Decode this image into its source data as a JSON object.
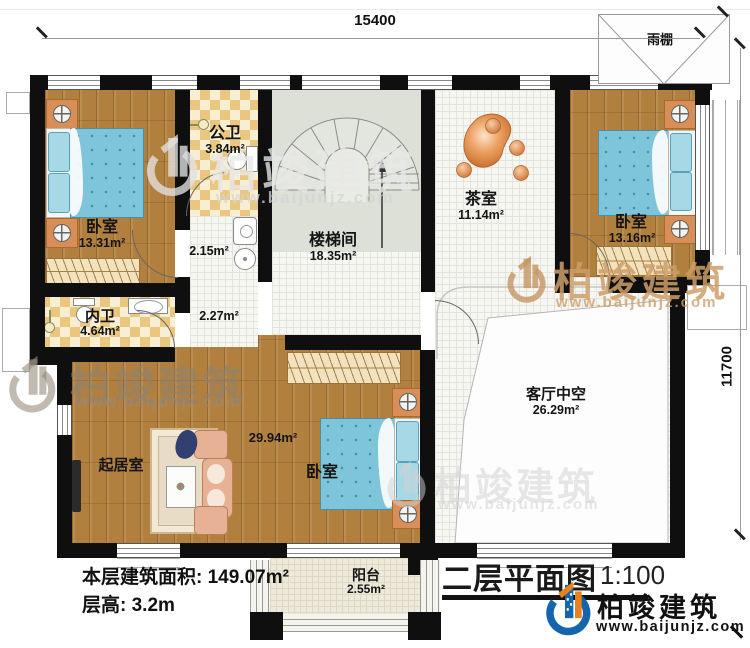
{
  "dimensions": {
    "top": "15400",
    "right": "11700"
  },
  "rooms": {
    "bedroom1": {
      "name": "卧室",
      "area": "13.31m²"
    },
    "public_bath": {
      "name": "公卫",
      "area": "3.84m²"
    },
    "stairwell": {
      "name": "楼梯间",
      "area": "18.35m²"
    },
    "tea_room": {
      "name": "茶室",
      "area": "11.14m²"
    },
    "bedroom2": {
      "name": "卧室",
      "area": "13.16m²"
    },
    "hall_small": {
      "area": "2.15m²"
    },
    "hall_lower": {
      "area": "2.27m²"
    },
    "inner_bath": {
      "name": "内卫",
      "area": "4.64m²"
    },
    "living_room": {
      "name": "起居室"
    },
    "bedroom3": {
      "name": "卧室",
      "area": "29.94m²"
    },
    "void": {
      "name": "客厅中空",
      "area": "26.29m²"
    },
    "balcony": {
      "name": "阳台",
      "area": "2.55m²"
    },
    "canopy": {
      "name": "雨棚"
    }
  },
  "footer": {
    "floor_area": "本层建筑面积: 149.07m²",
    "floor_height": "层高: 3.2m"
  },
  "titleblock": {
    "title": "二层平面图",
    "scale": "1:100"
  },
  "brand": {
    "name": "柏竣建筑",
    "url": "www.baijunjz.com"
  },
  "watermark": {
    "name": "柏竣建筑",
    "url": "www.baijunjz.com"
  },
  "colors": {
    "wall": "#0f0f0f",
    "brand_blue": "#1565ad",
    "brand_orange": "#e8821e"
  }
}
